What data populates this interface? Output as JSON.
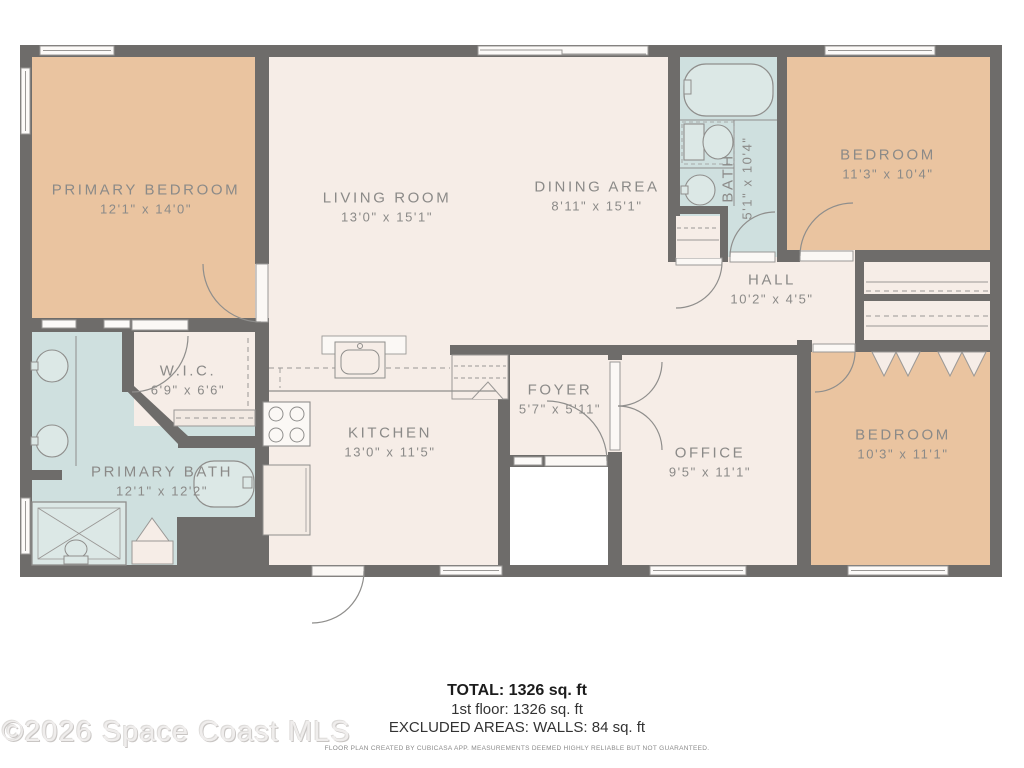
{
  "plan": {
    "colors": {
      "wall": "#6E6C6A",
      "floor_main": "#F6EDE7",
      "floor_bedroom": "#EAC4A0",
      "floor_bath": "#CFE0DF",
      "outline": "#8F8E8C"
    },
    "rooms": [
      {
        "id": "primary-bedroom",
        "name": "PRIMARY BEDROOM",
        "dims": "12'1\" x 14'0\""
      },
      {
        "id": "living-room",
        "name": "LIVING ROOM",
        "dims": "13'0\" x 15'1\""
      },
      {
        "id": "dining-area",
        "name": "DINING AREA",
        "dims": "8'11\" x 15'1\""
      },
      {
        "id": "bath",
        "name": "BATH",
        "dims": "5'1\" x 10'4\""
      },
      {
        "id": "bedroom-upper",
        "name": "BEDROOM",
        "dims": "11'3\" x 10'4\""
      },
      {
        "id": "hall",
        "name": "HALL",
        "dims": "10'2\" x 4'5\""
      },
      {
        "id": "wic",
        "name": "W.I.C.",
        "dims": "6'9\" x 6'6\""
      },
      {
        "id": "primary-bath",
        "name": "PRIMARY BATH",
        "dims": "12'1\" x 12'2\""
      },
      {
        "id": "kitchen",
        "name": "KITCHEN",
        "dims": "13'0\" x 11'5\""
      },
      {
        "id": "foyer",
        "name": "FOYER",
        "dims": "5'7\" x 5'11\""
      },
      {
        "id": "office",
        "name": "OFFICE",
        "dims": "9'5\" x 11'1\""
      },
      {
        "id": "bedroom-lower",
        "name": "BEDROOM",
        "dims": "10'3\" x 11'1\""
      }
    ],
    "fixtures": [
      "bathtub",
      "toilet",
      "round-sink",
      "shower",
      "stove",
      "fridge",
      "kitchen-sink",
      "closet-shelves",
      "door-arcs",
      "windows"
    ]
  },
  "footer": {
    "total": "TOTAL: 1326 sq. ft",
    "first_floor": "1st floor: 1326 sq. ft",
    "excluded": "EXCLUDED AREAS: WALLS: 84 sq. ft",
    "disclaimer": "FLOOR PLAN CREATED BY CUBICASA APP. MEASUREMENTS DEEMED HIGHLY RELIABLE BUT NOT GUARANTEED."
  },
  "watermark": "©2026 Space Coast MLS"
}
